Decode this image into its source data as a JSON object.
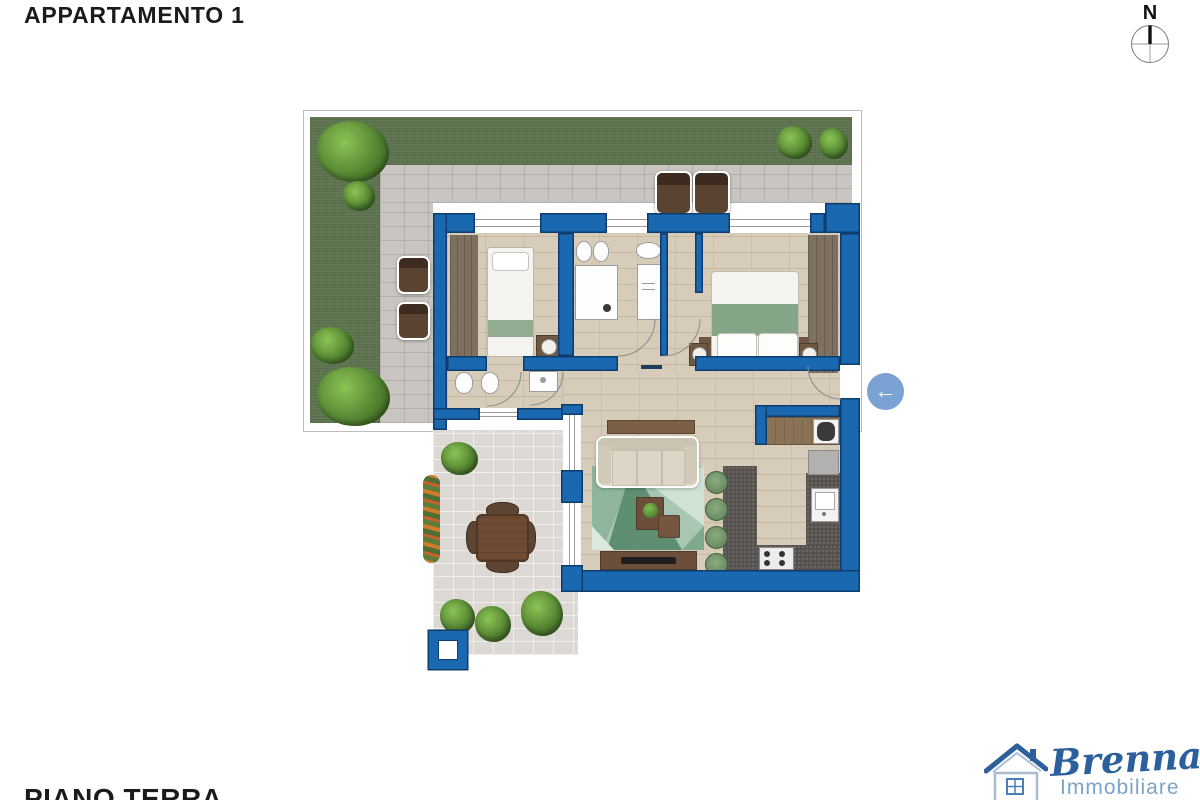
{
  "header": {
    "title": "APPARTAMENTO 1"
  },
  "footer": {
    "floor_label": "PIANO TERRA"
  },
  "compass": {
    "north_label": "N"
  },
  "entrance_arrow": {
    "direction": "left",
    "glyph": "←",
    "color": "#7aa3d4"
  },
  "logo": {
    "name": "Brenna",
    "subtitle": "Immobiliare",
    "name_color": "#2b609c",
    "subtitle_color": "#7ba4c8",
    "roof_color": "#2d5f9b"
  },
  "colors": {
    "wall_blue": "#1a68af",
    "wall_outline": "#0d3d6e",
    "grass_green": "#5d734e",
    "garden_paver": "#c9c5c0",
    "terrace_paver": "#dcd9d4",
    "wood_floor": "#d7cbb9",
    "rug_green": "#8fb8a0",
    "kitchen_counter": "#57524e",
    "furniture_brown": "#6b4f3b",
    "bed_blanket_green": "#84a586",
    "stool_green": "#6f9068",
    "text_dark": "#1b1b1d"
  },
  "icons": [
    "compass-icon",
    "arrow-left-icon",
    "house-logo-icon"
  ]
}
